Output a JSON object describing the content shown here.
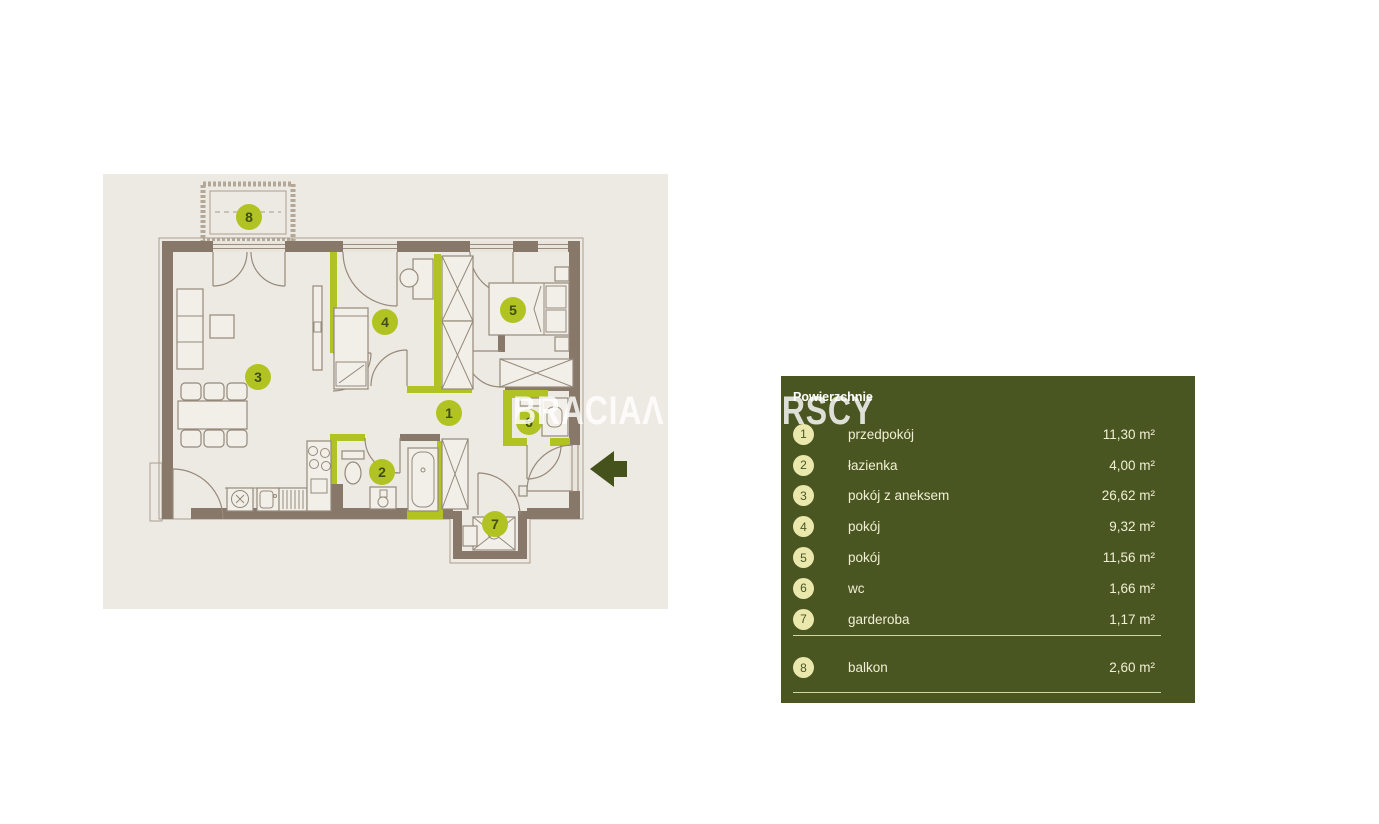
{
  "watermark": {
    "left_part": "BRACIAΛ",
    "right_part": "SADURSCY"
  },
  "colors": {
    "accent_lime": "#b1c322",
    "panel_olive": "#4a5621",
    "wall_brown": "#87786a",
    "plan_bg": "#edeae3",
    "badge_cream": "#ebe8ae",
    "arrow_olive": "#46521c",
    "legend_text": "#f1efd3",
    "divider": "#d3d59b"
  },
  "floor_plan": {
    "badges": [
      {
        "n": "1",
        "x": 346,
        "y": 239
      },
      {
        "n": "2",
        "x": 279,
        "y": 298
      },
      {
        "n": "3",
        "x": 155,
        "y": 203
      },
      {
        "n": "4",
        "x": 282,
        "y": 148
      },
      {
        "n": "5",
        "x": 410,
        "y": 136
      },
      {
        "n": "6",
        "x": 426,
        "y": 248
      },
      {
        "n": "7",
        "x": 392,
        "y": 350
      },
      {
        "n": "8",
        "x": 146,
        "y": 43
      }
    ]
  },
  "legend": {
    "header": "Powierzchnie",
    "rows": [
      {
        "n": "1",
        "label": "przedpokój",
        "area": "11,30 m²"
      },
      {
        "n": "2",
        "label": "łazienka",
        "area": "4,00 m²"
      },
      {
        "n": "3",
        "label": "pokój z aneksem",
        "area": "26,62 m²"
      },
      {
        "n": "4",
        "label": "pokój",
        "area": "9,32 m²"
      },
      {
        "n": "5",
        "label": "pokój",
        "area": "11,56 m²"
      },
      {
        "n": "6",
        "label": "wc",
        "area": "1,66 m²"
      },
      {
        "n": "7",
        "label": "garderoba",
        "area": "1,17 m²"
      }
    ],
    "rows_below": [
      {
        "n": "8",
        "label": "balkon",
        "area": "2,60 m²"
      }
    ]
  }
}
